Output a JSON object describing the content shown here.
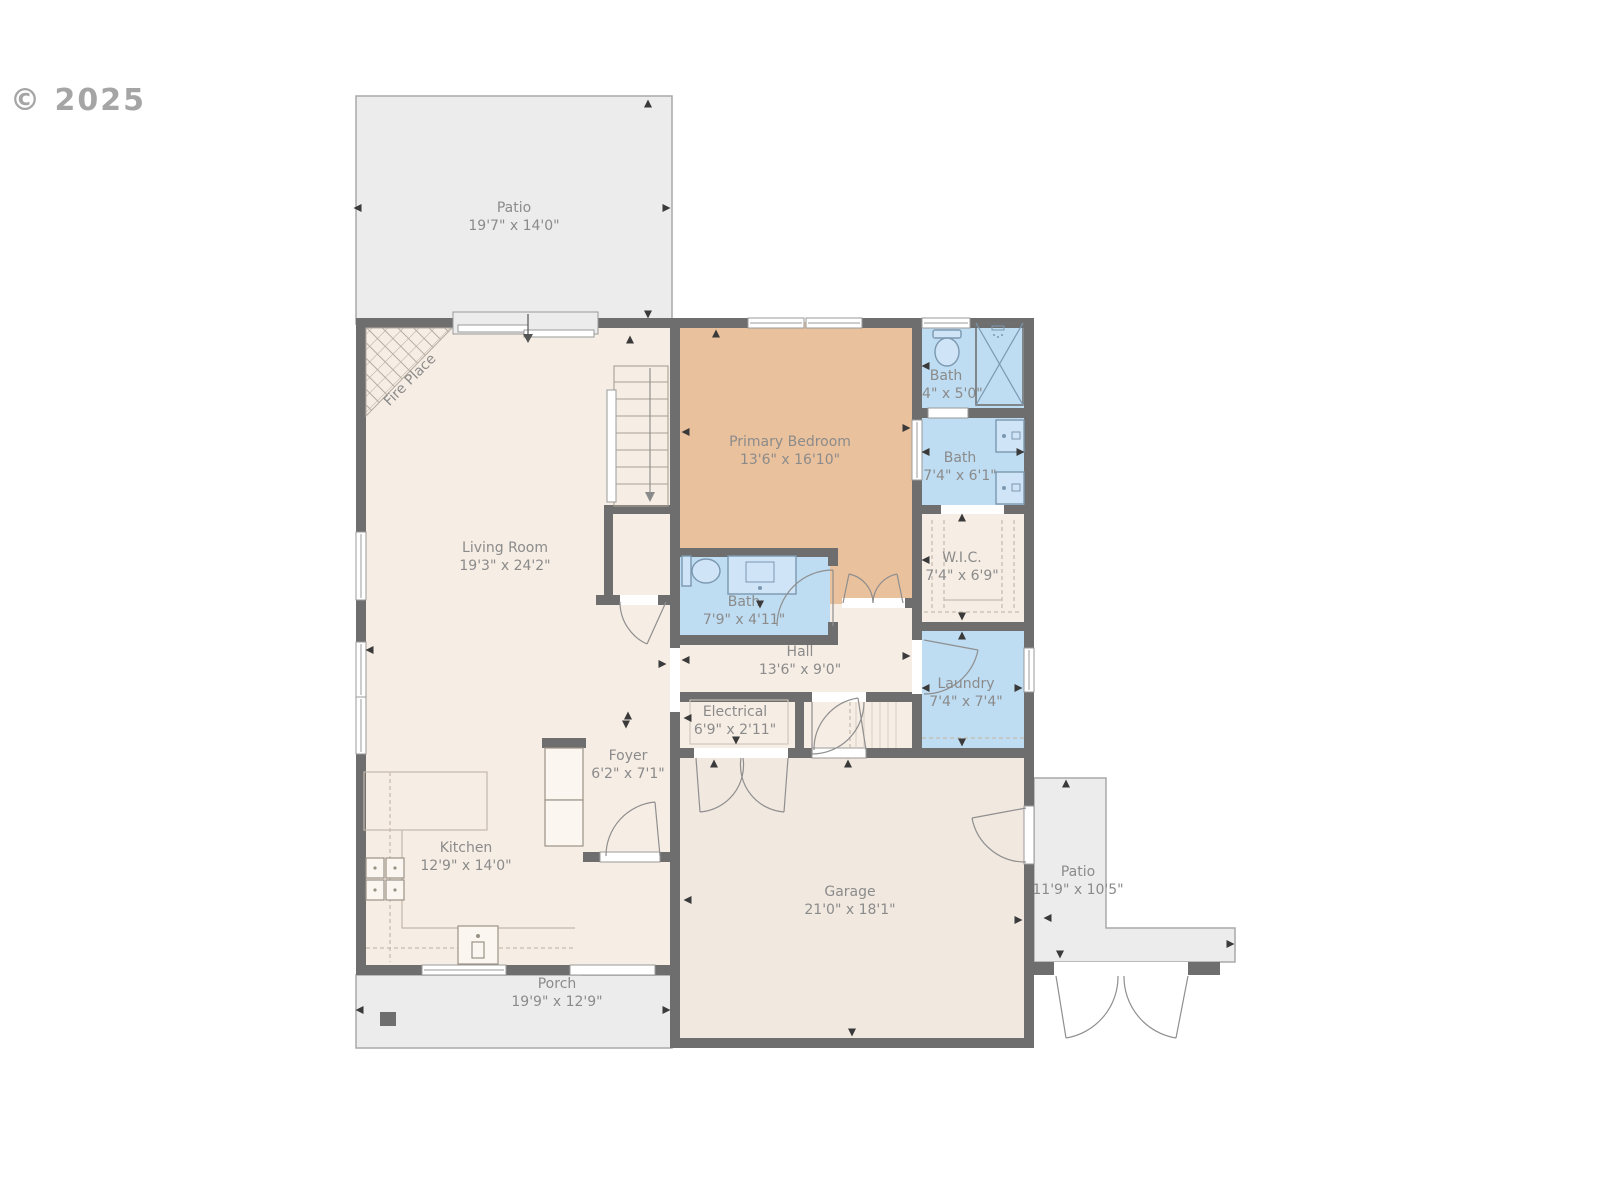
{
  "watermark": "© 2025",
  "colors": {
    "wall": "#6e6e6e",
    "floor_cream": "#f6ede4",
    "floor_garage": "#f1e8e0",
    "bedroom_tan": "#eac19d",
    "bath_blue": "#bedcf2",
    "outdoor_gray": "#ececec",
    "label_text": "#8b8b8b"
  },
  "rooms": {
    "patio_top": {
      "name": "Patio",
      "dims": "19'7\" x 14'0\""
    },
    "living": {
      "name": "Living Room",
      "dims": "19'3\" x 24'2\""
    },
    "fireplace": {
      "name": "Fire Place"
    },
    "primary_bedroom": {
      "name": "Primary Bedroom",
      "dims": "13'6\" x 16'10\""
    },
    "bath_small": {
      "name": "Bath",
      "dims": "7'4\" x 5'0\""
    },
    "bath_ensuite": {
      "name": "Bath",
      "dims": "7'4\" x 6'1\""
    },
    "wic": {
      "name": "W.I.C.",
      "dims": "7'4\" x 6'9\""
    },
    "bath_hall": {
      "name": "Bath",
      "dims": "7'9\" x 4'11\""
    },
    "hall": {
      "name": "Hall",
      "dims": "13'6\" x 9'0\""
    },
    "laundry": {
      "name": "Laundry",
      "dims": "7'4\" x 7'4\""
    },
    "electrical": {
      "name": "Electrical",
      "dims": "6'9\" x 2'11\""
    },
    "foyer": {
      "name": "Foyer",
      "dims": "6'2\" x 7'1\""
    },
    "kitchen": {
      "name": "Kitchen",
      "dims": "12'9\" x 14'0\""
    },
    "garage": {
      "name": "Garage",
      "dims": "21'0\" x 18'1\""
    },
    "patio_right": {
      "name": "Patio",
      "dims": "11'9\" x 10'5\""
    },
    "porch": {
      "name": "Porch",
      "dims": "19'9\" x 12'9\""
    }
  }
}
